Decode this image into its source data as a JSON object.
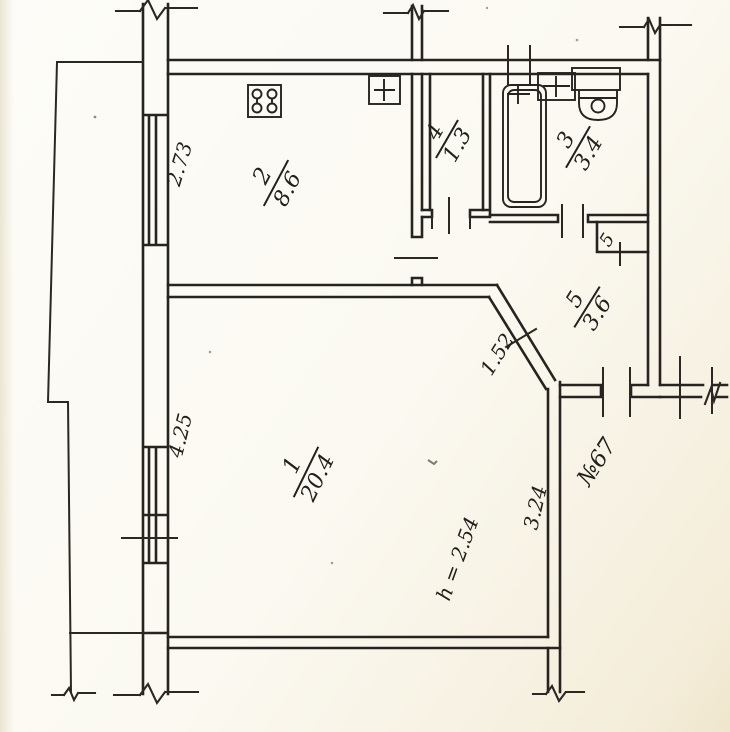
{
  "plan": {
    "type": "apartment-floor-plan",
    "apartment_label": "№67",
    "ceiling_height": "h = 2.54",
    "rooms": [
      {
        "number": "1",
        "area": "20.4"
      },
      {
        "number": "2",
        "area": "8.6"
      },
      {
        "number": "3",
        "area": "3.4"
      },
      {
        "number": "4",
        "area": "1.3"
      },
      {
        "number": "5",
        "area": "3.6"
      }
    ],
    "closet_number": "5",
    "dimensions": {
      "kitchen_window_wall": "2.73",
      "living_window_wall": "4.25",
      "hall_diagonal": "1.52",
      "living_right_wall": "3.24"
    },
    "colors": {
      "ink": "#262320",
      "paper": "#fbf9f1"
    }
  }
}
